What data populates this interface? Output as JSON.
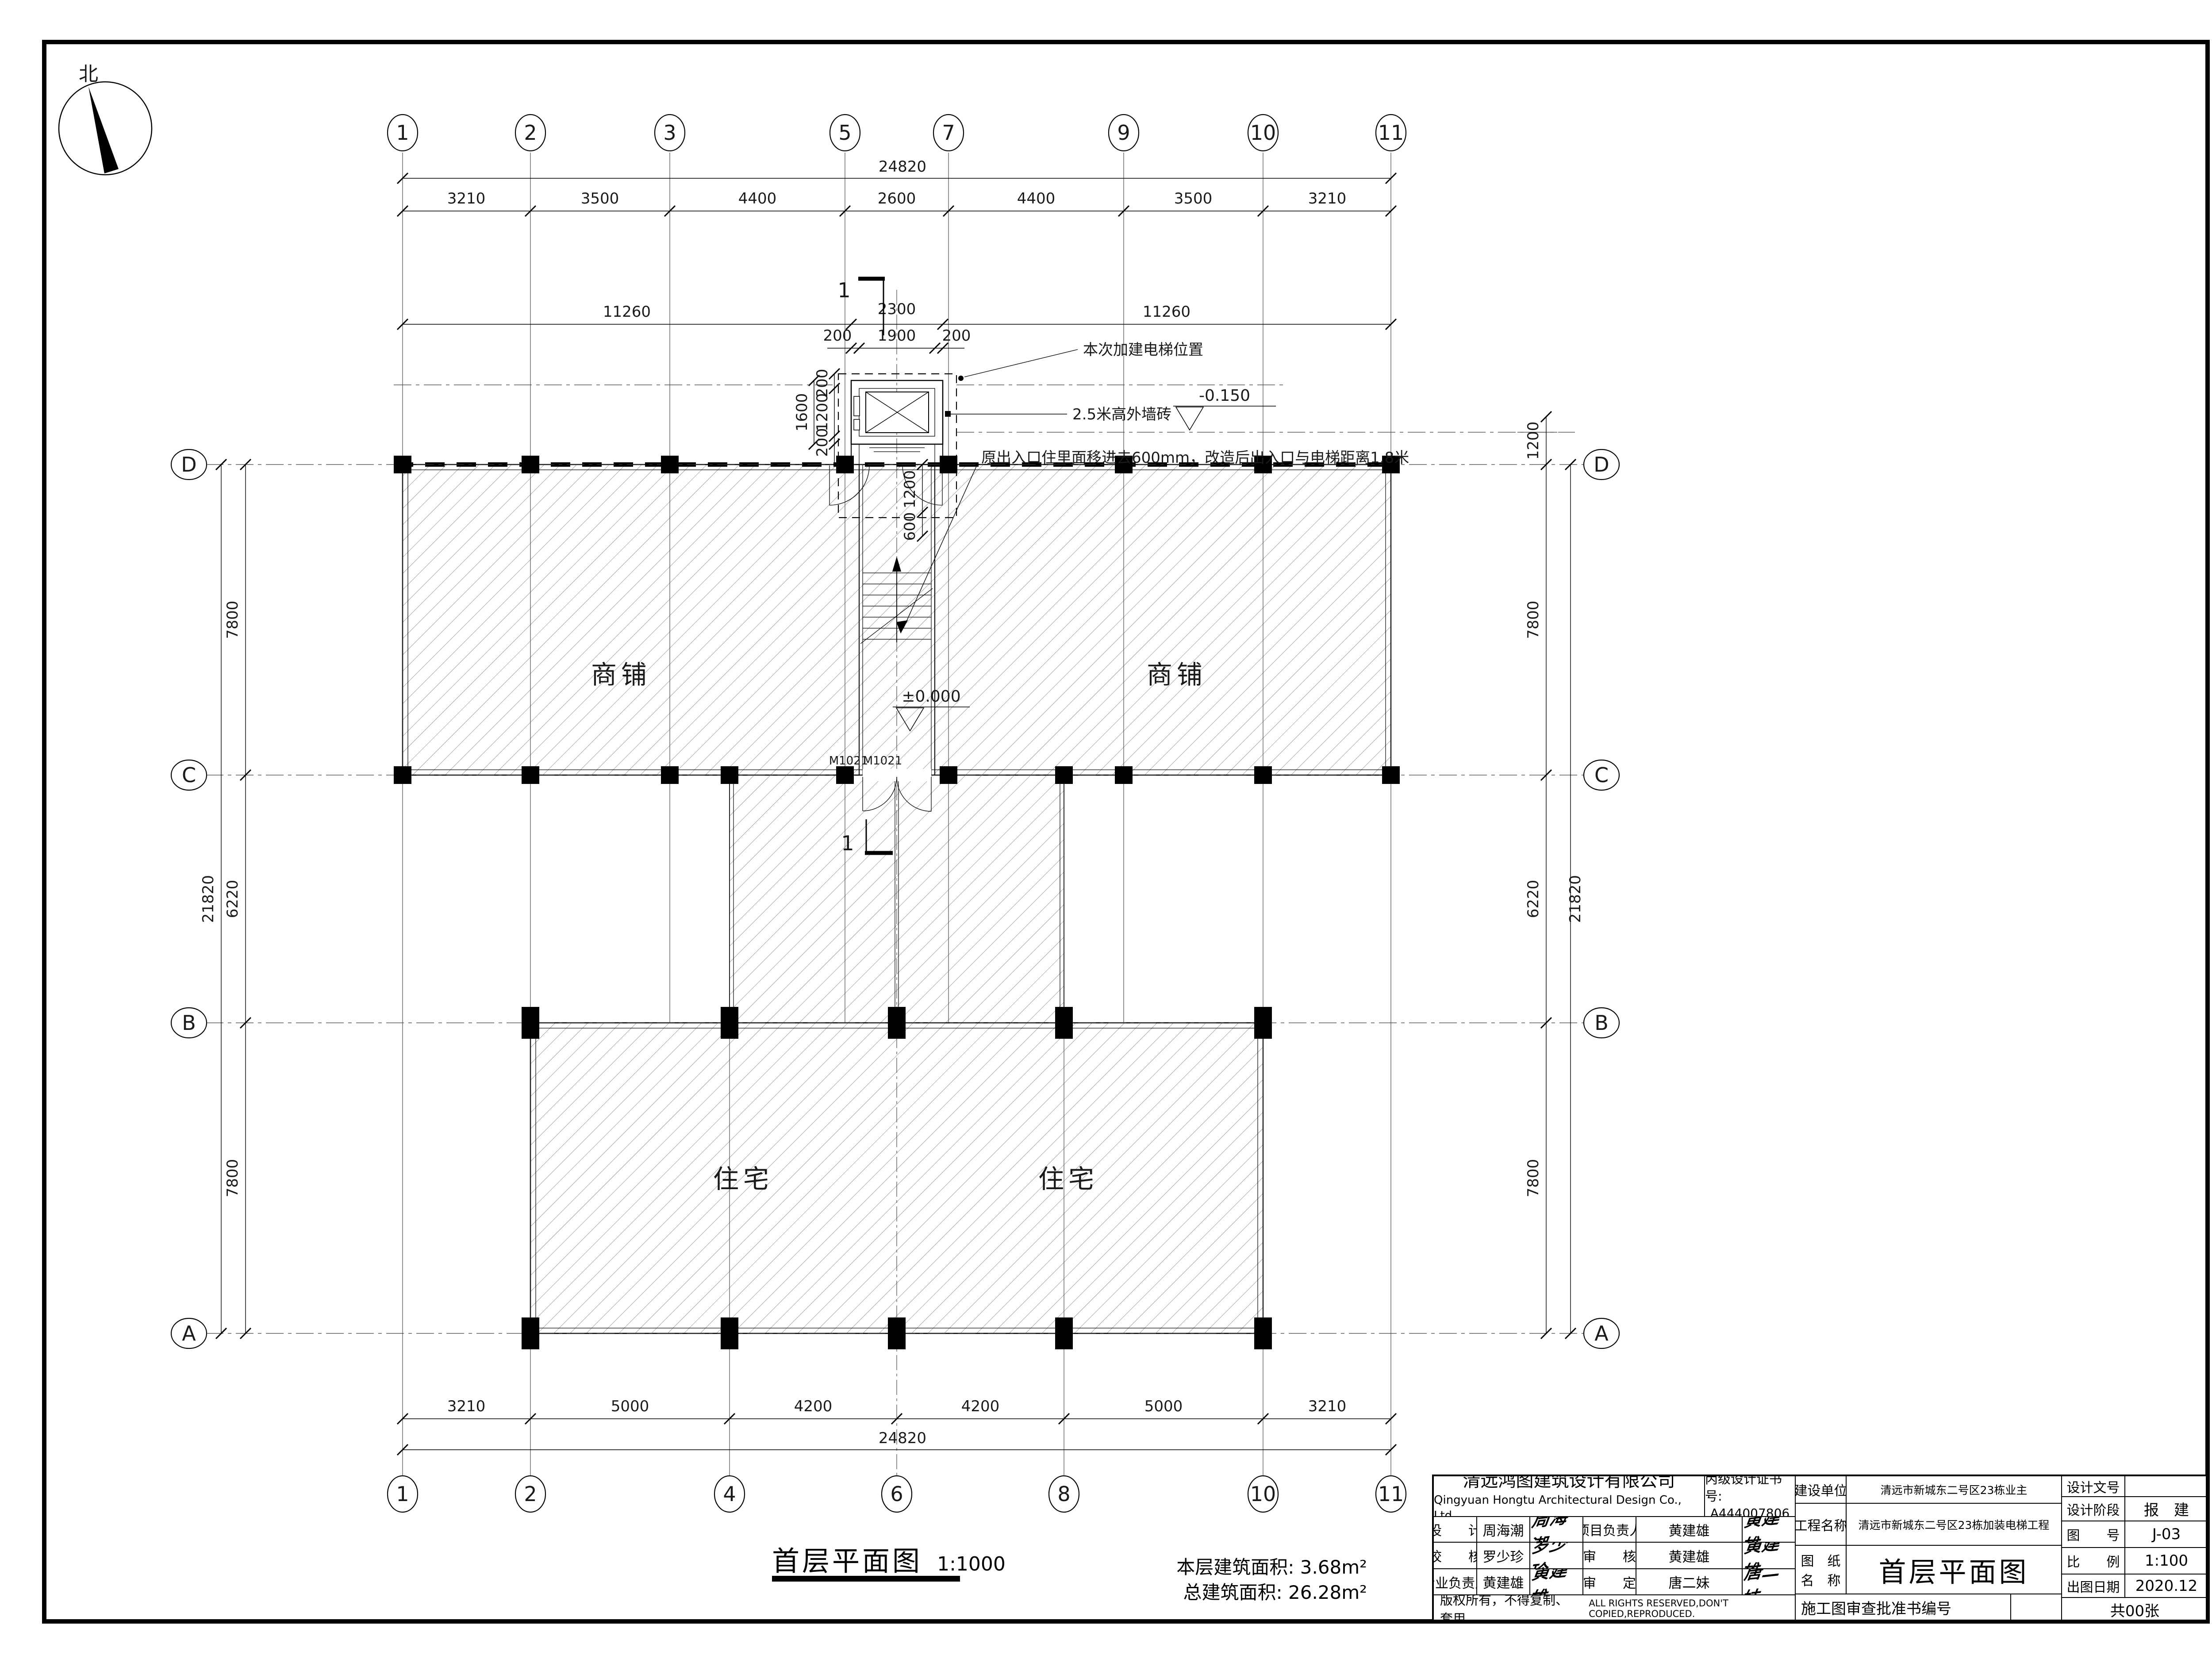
{
  "sheet": {
    "compass": "北",
    "plan_title": "首层平面图",
    "plan_scale": "1:1000",
    "area1_label": "本层建筑面积:",
    "area1_value": "3.68m²",
    "area2_label": "总建筑面积:",
    "area2_value": "26.28m²"
  },
  "grid": {
    "top_bubbles": [
      "1",
      "2",
      "3",
      "5",
      "7",
      "9",
      "10",
      "11"
    ],
    "bottom_bubbles": [
      "1",
      "2",
      "4",
      "6",
      "8",
      "10",
      "11"
    ],
    "row_bubbles": [
      "D",
      "C",
      "B",
      "A"
    ],
    "top_dims": [
      "3210",
      "3500",
      "4400",
      "2600",
      "4400",
      "3500",
      "3210"
    ],
    "top_total": "24820",
    "mid_dims": [
      "11260",
      "2300",
      "11260"
    ],
    "bottom_dims": [
      "3210",
      "5000",
      "4200",
      "4200",
      "5000",
      "3210"
    ],
    "bottom_total": "24820",
    "left_dims": [
      "7800",
      "6220",
      "7800"
    ],
    "left_total": "21820",
    "right_dims": [
      "1200",
      "7800",
      "6220",
      "7800"
    ],
    "right_total": "21820"
  },
  "elevator": {
    "top_chain": [
      "200",
      "1900",
      "200"
    ],
    "left_outer": "1600",
    "left_chain": [
      "200",
      "1200",
      "200"
    ],
    "entry_chain": [
      "1200",
      "600"
    ],
    "note_position": "本次加建电梯位置",
    "note_wall": "2.5米高外墙砖",
    "level_minus": "-0.150",
    "note_entrance": "原出入口住里面移进去600mm，改造后出入口与电梯距离1.8米"
  },
  "plan": {
    "room_shop": "商铺",
    "room_residence": "住宅",
    "level_zero": "±0.000",
    "door_label": "M1021",
    "section_no": "1"
  },
  "titleblock": {
    "company_cn": "清远鸿图建筑设计有限公司",
    "company_en": "Qingyuan  Hongtu Architectural Design Co., Ltd.",
    "cert_label": "丙级设计证书号:",
    "cert_no": "A444007806",
    "rows": [
      {
        "label": "设　　计",
        "name": "周海潮",
        "sig": "周海潮",
        "label2": "项目负责人",
        "name2": "黄建雄",
        "sig2": "黄建雄"
      },
      {
        "label": "校　　核",
        "name": "罗少珍",
        "sig": "罗少珍",
        "label2": "审　　核",
        "name2": "黄建雄",
        "sig2": "黄建雄"
      },
      {
        "label": "专业负责人",
        "name": "黄建雄",
        "sig": "黄建雄",
        "label2": "审　　定",
        "name2": "唐二妹",
        "sig2": "唐二妹"
      }
    ],
    "copyright_cn": "版权所有，不得复制、套用。",
    "copyright_en": "ALL RIGHTS RESERVED,DON'T COPIED,REPRODUCED.",
    "client_label": "建设单位",
    "client": "清远市新城东二号区23栋业主",
    "project_label": "工程名称",
    "project": "清远市新城东二号区23栋加装电梯工程",
    "drawing_label": "图　纸\n名　称",
    "drawing_name": "首层平面图",
    "approval_label": "施工图审查批准书编号",
    "doc_label": "设计文号",
    "doc_value": "",
    "stage_label": "设计阶段",
    "stage": "报　建",
    "no_label": "图　　号",
    "no": "J-03",
    "scale_label": "比　　例",
    "scale": "1:100",
    "date_label": "出图日期",
    "date": "2020.12",
    "sheets": "共00张"
  }
}
